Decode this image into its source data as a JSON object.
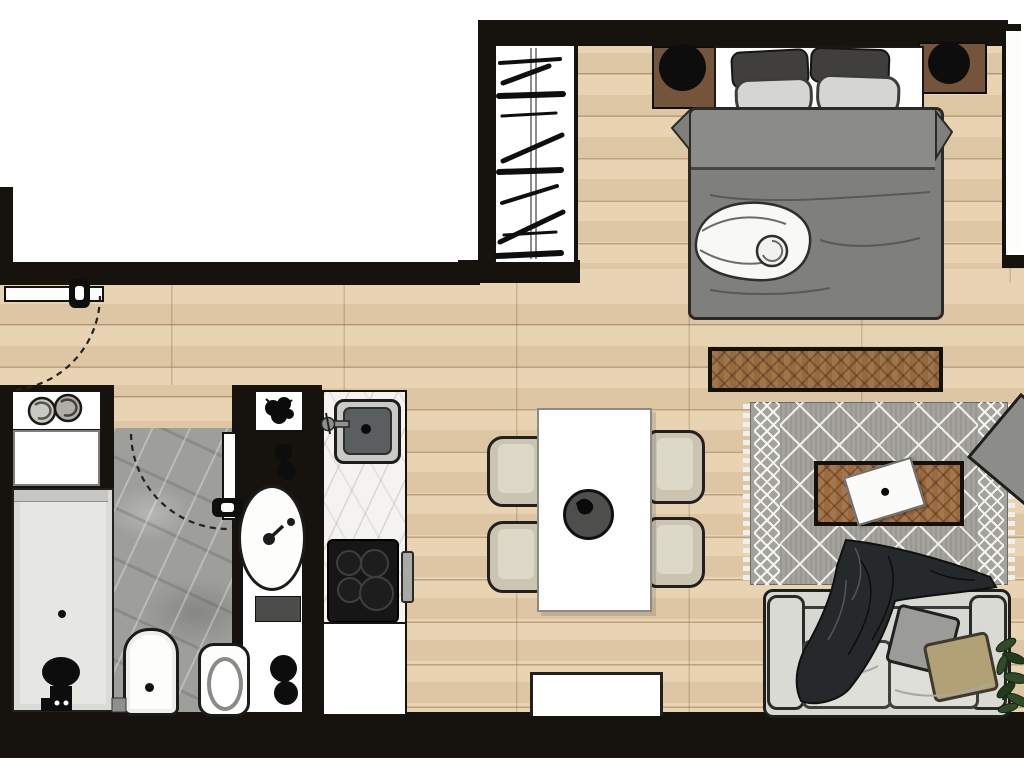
{
  "meta": {
    "title": "Studio apartment floor plan",
    "style": "top-down furnished render, no text labels"
  },
  "palette": {
    "wall": "#16130f",
    "outside": "#ffffff",
    "wood_floor": "#e6d0ad",
    "wood_plank_line": "#946e46",
    "bath_marble": "#9e9e9a",
    "counter_marble": "#f4f3f0",
    "bed_duvet": "#7f7f7c",
    "bed_fold_band": "#8b8b88",
    "pillow_dark": "#403f3d",
    "pillow_light": "#d5d5d1",
    "nightstand_wood": "#74543a",
    "lamp": "#0d0d0d",
    "bench_wood": "#976a3d",
    "coffee_table_wood": "#9c6b3e",
    "rug": "#a3a29c",
    "rug_pattern": "#f2f2ed",
    "sofa": "#d8d8d3",
    "sofa_blanket": "#26292b",
    "cushion_gray": "#9b9b98",
    "cushion_tan": "#b2a177",
    "dining_chair": "#cbc4b0",
    "dining_table": "#fefefe",
    "centerpiece_bowl": "#4e4e4c",
    "cooktop": "#161616",
    "sink_basin": "#5a5e60",
    "shower_tray": "#e6e6e2",
    "plant_green": "#2f4b28"
  },
  "rooms": {
    "bedroom": {
      "label": "Bedroom",
      "items": [
        "wardrobe with hanging rail and hangers",
        "left nightstand with lamp",
        "right nightstand with lamp",
        "headboard with four pillows",
        "double bed with gray duvet",
        "white throw roll",
        "foot bench"
      ]
    },
    "living": {
      "label": "Living area",
      "items": [
        "patterned area rug with fringe",
        "wood coffee table",
        "white tray",
        "rotated armchair",
        "two-seat sofa",
        "gray cushion",
        "tan cushion",
        "draped dark blanket",
        "potted plant",
        "tv console"
      ]
    },
    "dining": {
      "label": "Dining area",
      "items": [
        "white dining table",
        "four beige chairs",
        "dark centerpiece bowl"
      ]
    },
    "kitchen": {
      "label": "Kitchenette",
      "items": [
        "marble counter",
        "inset sink with faucet",
        "four-burner cooktop",
        "base cabinet",
        "counter handle"
      ]
    },
    "bathroom": {
      "label": "Bathroom",
      "items": [
        "walk-in shower with drain",
        "black stool",
        "bidet",
        "toilet",
        "vanity counter",
        "oval basin with faucet",
        "soap bottles",
        "towel",
        "waste bins",
        "towel niche with rolled towels",
        "decor niche with plant",
        "inward swing door"
      ]
    },
    "entry": {
      "label": "Entry",
      "items": [
        "entrance door with swing arc",
        "door handle"
      ]
    }
  },
  "openings": {
    "windows_right_wall": 1,
    "doors": 2
  }
}
